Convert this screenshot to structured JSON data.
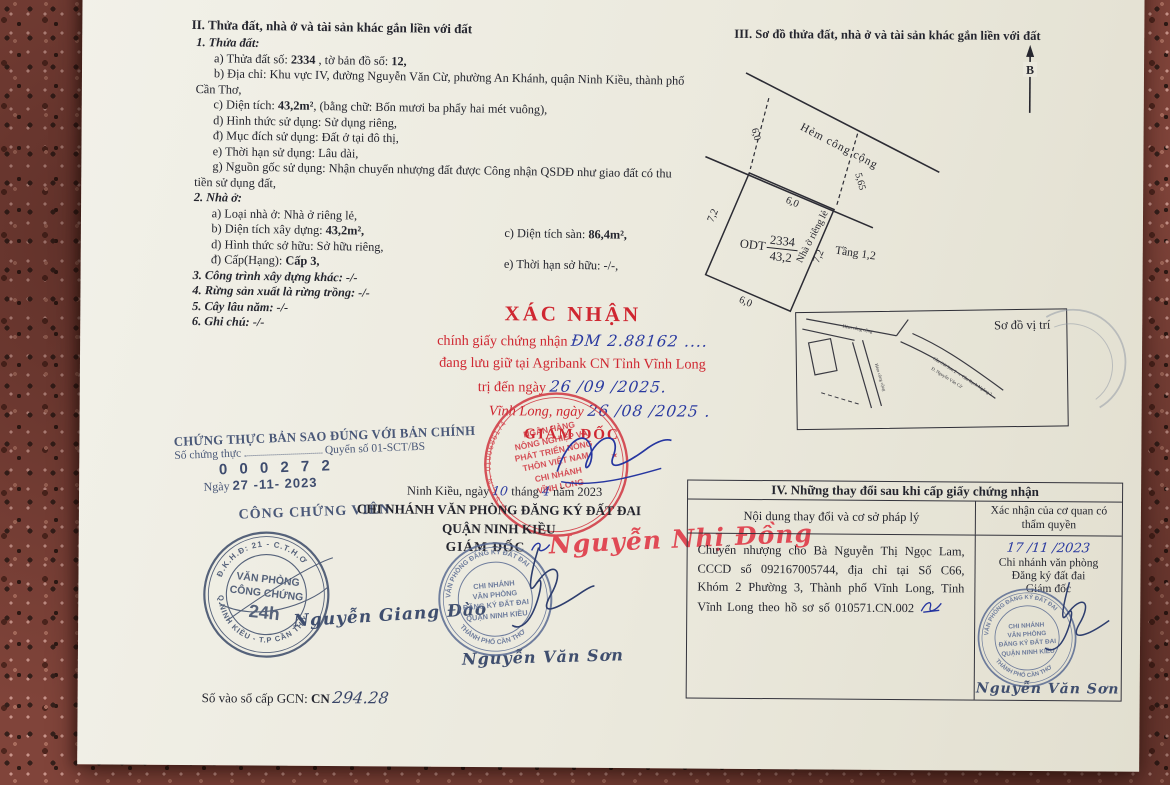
{
  "s2": {
    "title": "II. Thửa đất, nhà ở và tài sản khác gắn liền với đất",
    "h1": "1. Thửa đất:",
    "a_pre": "a) Thửa đất số: ",
    "a_num": "2334",
    "a_mid": " , tờ bản đồ số: ",
    "a_map": "12,",
    "b": "b) Địa chỉ: Khu vực IV, đường Nguyễn Văn Cừ, phường An Khánh, quận Ninh Kiều, thành phố Cần Thơ,",
    "c_pre": "c) Diện tích: ",
    "c_val": "43,2m²",
    "c_post": ", (bằng chữ: Bốn mươi ba phẩy hai mét vuông),",
    "d": "d) Hình thức sử dụng: Sử dụng riêng,",
    "dd": "đ) Mục đích sử dụng: Đất ở tại đô thị,",
    "e": "e) Thời hạn sử dụng: Lâu dài,",
    "g": "g) Nguồn gốc sử dụng: Nhận chuyển nhượng đất được Công nhận QSDĐ như giao đất có thu tiền sử dụng đất,",
    "h2": "2. Nhà ở:",
    "na": "a) Loại nhà ở: Nhà ở riêng lẻ,",
    "nb_pre": "b) Diện tích xây dựng: ",
    "nb_val": "43,2m²,",
    "nc_pre": "c) Diện tích sàn: ",
    "nc_val": "86,4m²,",
    "nd": "d) Hình thức sở hữu: Sở hữu riêng,",
    "ndd_pre": "đ) Cấp(Hạng): ",
    "ndd_val": "Cấp 3,",
    "ne": "e) Thời hạn sở hữu: -/-,",
    "h3": "3. Công trình xây dựng khác: -/-",
    "h4": "4. Rừng sản xuất là rừng trồng: -/-",
    "h5": "5. Cây lâu năm: -/-",
    "h6": "6. Ghi chú: -/-"
  },
  "s3": {
    "title": "III. Sơ đồ thửa đất, nhà ở và tài sản khác gắn liền với đất",
    "north": "B",
    "alley": "Hẻm công cộng",
    "dim_alley_left": "6,0",
    "dim_alley_right": "5,65",
    "dim_top": "6,0",
    "dim_left": "7,2",
    "dim_right": "7,2",
    "dim_bottom": "6,0",
    "parcel_type": "ODT",
    "parcel_no": "2334",
    "parcel_area": "43,2",
    "house": "Nhà ở riêng lẻ",
    "floors": "Tầng 1,2",
    "inset_title": "Sơ đồ vị trí",
    "inset_label1": "Hẻm công cộng",
    "inset_label2": "Hẻm công cộng",
    "inset_label3": "Cầu Cái Sơn 2 → Cầu Rạch Ngỗng 2",
    "inset_label4": "Đ. Nguyễn Văn Cừ"
  },
  "xn": {
    "title": "XÁC NHẬN",
    "l1_pre": "chính giấy chứng nhận",
    "l1_hand": "ĐM 2.88162 ....",
    "l2": "đang lưu giữ tại Agribank CN Tỉnh Vĩnh Long",
    "l3_pre": "trị đến ngày",
    "l3_hand": "26 /09 /2025.",
    "l4_pre": "Vĩnh Long, ngày",
    "l4_hand": "26 /08 /2025 .",
    "director": "GIÁM ĐỐC",
    "stamp": {
      "ring_left": "M.S.C.N. 0100686174",
      "ring_right": "★",
      "c1": "NGÂN HÀNG",
      "c2": "NÔNG NGHIỆP VÀ",
      "c3": "PHÁT TRIỂN NÔNG",
      "c4": "THÔN VIỆT NAM",
      "c5": "CHI NHÁNH",
      "c6": "VĨNH LONG"
    }
  },
  "ct": {
    "l1": "CHỨNG THỰC BẢN SAO ĐÚNG VỚI BẢN CHÍNH",
    "l2a": "Số chứng thực",
    "l2b": "Quyển số 01-SCT/BS",
    "num": "0 0 0 2 7 2",
    "day_pre": "Ngày",
    "day_val": "27 -11- 2023",
    "role": "CÔNG CHỨNG VIÊN",
    "sign": "Nguyễn Giang Đào",
    "stamp": {
      "ring_top": "Đ.K.H.Đ: 21 - C.T.H.Ơ",
      "ring_bottom": "Q.NINH KIỀU - T.P CẦN THƠ",
      "c1": "VĂN PHÒNG",
      "c2": "CÔNG CHỨNG",
      "c3": "24h"
    }
  },
  "reg": {
    "date_pre": "Ninh Kiều, ngày",
    "date_d": "10",
    "date_mid": "tháng",
    "date_m": "4",
    "date_post": "năm 2023",
    "org1": "CHI NHÁNH VĂN PHÒNG ĐĂNG KÝ ĐẤT ĐAI",
    "org2": "QUẬN NINH KIỀU",
    "role": "GIÁM ĐỐC",
    "name_red": "Nguyễn Nhị Đồng",
    "name_blue": "Nguyễn Văn Sơn",
    "stamp": {
      "ring_top": "VĂN PHÒNG ĐĂNG KÝ ĐẤT ĐAI",
      "ring_bottom": "THÀNH PHỐ CẦN THƠ",
      "c1": "CHI NHÁNH",
      "c2": "VĂN PHÒNG",
      "c3": "ĐĂNG KÝ ĐẤT ĐAI",
      "c4": "QUẬN NINH KIỀU"
    }
  },
  "gcn": {
    "pre": "Số vào sổ cấp GCN: ",
    "cn": "CN",
    "val": "294.28"
  },
  "t4": {
    "title": "IV. Những thay đổi sau khi cấp giấy chứng nhận",
    "col1": "Nội dung thay đổi và cơ sở pháp lý",
    "col2": "Xác nhận của cơ quan có thẩm quyền",
    "content": "Chuyển nhượng cho Bà Nguyễn Thị Ngọc Lam, CCCD số 092167005744, địa chỉ tại Số C66, Khóm 2 Phường 3, Thành phố Vĩnh Long, Tỉnh Vĩnh Long theo hồ sơ số 010571.CN.002",
    "confirm_date": "17 /11 /2023",
    "confirm1": "Chi nhánh văn phòng",
    "confirm2": "Đăng ký đất đai",
    "confirm3": "Giám đốc",
    "signer": "Nguyễn Văn Sơn"
  }
}
